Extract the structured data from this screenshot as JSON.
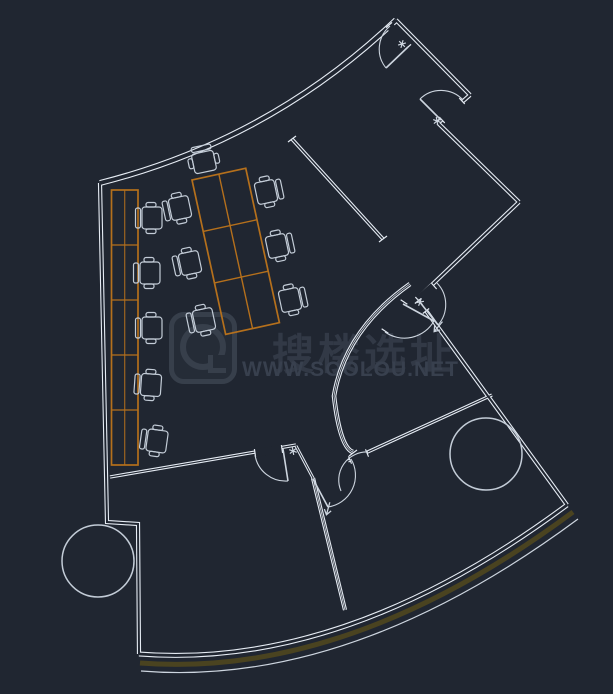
{
  "watermark": {
    "title": "搜楼选址",
    "url": "WWW.SOOLOU.NET",
    "logo_name": "soolou-logo"
  },
  "colors": {
    "background": "#202631",
    "wall": "#e6ecf4",
    "door": "#cdd5df",
    "desk": "#b5701c",
    "chair": "#c3ccd7",
    "olive": "#4a4320",
    "watermark_ink": "#333b48",
    "watermark_url": "#3a4250",
    "logo_line": "#39414d"
  },
  "floorplan": {
    "exterior_walls": [
      {
        "d": "M 100,183 Q 270,140 396,20",
        "w": 6
      },
      {
        "d": "M 396,20 L 470,95",
        "w": 4.2
      },
      {
        "d": "M 470,95 L 438,123",
        "w": 4.2
      },
      {
        "d": "M 438,123 L 519,202",
        "w": 4.2
      },
      {
        "d": "M 519,202 L 417,299",
        "w": 4.2
      },
      {
        "d": "M 419,301 L 567,505",
        "w": 4.2
      },
      {
        "d": "M 567,505 Q 345,670 139,654",
        "w": 5
      },
      {
        "d": "M 100,183 L 107,522 L 138,524 L 139,654",
        "w": 4.2
      }
    ],
    "interior_walls": [
      {
        "d": "M 292,139 L 383,239",
        "w": 3.6
      },
      {
        "d": "M 410,284 Q 345,330 334,396 Q 340,448 353,452",
        "w": 4.6,
        "hairline": true
      },
      {
        "d": "M 348,461 L 492,395",
        "w": 3.4
      },
      {
        "d": "M 110,477 L 296,445",
        "w": 3.4
      },
      {
        "d": "M 296,446 L 313,478",
        "w": 3
      },
      {
        "d": "M 313,478 L 345,610",
        "w": 4.2,
        "hairline": true
      }
    ],
    "facade_band": [
      {
        "d": "M 573,512 Q 348,679 140,663",
        "w": 5,
        "color": "olive"
      },
      {
        "d": "M 578,519 Q 350,688 141,671",
        "w": 1.2,
        "color": "door"
      }
    ],
    "openings": [
      [
        389,
        25,
        408,
        47
      ],
      [
        462,
        101,
        442,
        120
      ],
      [
        434,
        286,
        418,
        300
      ],
      [
        418,
        301,
        426,
        311
      ],
      [
        404,
        302,
        385,
        331
      ],
      [
        350,
        460,
        367,
        453
      ],
      [
        255,
        453,
        282,
        449
      ]
    ],
    "end_caps": [
      [
        288,
        142,
        296,
        136
      ],
      [
        379,
        242,
        387,
        236
      ],
      [
        349,
        456,
        357,
        450
      ]
    ],
    "doors": [
      {
        "leaf": "M 408,47 L 386,68",
        "arc": "M 386,68 A 30,30 0 0 1 390,26"
      },
      {
        "leaf": "M 441,120 L 420,99",
        "arc": "M 420,99 A 30,30 0 0 1 463,100"
      },
      {
        "leaf": "M 419,301 L 438,325",
        "arc": "M 437,283 A 31,31 0 0 1 438,325"
      },
      {
        "leaf": "M 403,304 L 434,321",
        "arc": "M 385,332 A 34,34 0 0 0 434,321"
      },
      {
        "arc": "M 368,452 A 28,28 0 0 0 341,491"
      },
      {
        "leaf": "M 313,479 L 328,507",
        "arc": "M 328,507 A 32,32 0 0 0 351,459"
      },
      {
        "leaf": "M 283,449 L 288,481",
        "arc": "M 255,455 A 31,31 0 0 0 288,481"
      }
    ],
    "markers": [
      {
        "x": 402,
        "y": 44,
        "rot": 45,
        "type": "stop"
      },
      {
        "x": 437,
        "y": 121,
        "rot": -40,
        "type": "stop"
      },
      {
        "x": 420,
        "y": 302,
        "rot": 50,
        "type": "stop"
      },
      {
        "x": 293,
        "y": 451,
        "rot": 80,
        "type": "stop"
      },
      {
        "x": 438,
        "y": 327,
        "rot": 40,
        "type": "arrow"
      },
      {
        "x": 328,
        "y": 509,
        "rot": 15,
        "type": "arrow"
      }
    ],
    "desk_bank_left": {
      "x": 111.5,
      "y": 190,
      "w": 26.5,
      "h": 275,
      "rows": 5
    },
    "desk_island": {
      "x": 192,
      "y": 180,
      "rot": -12.3,
      "w": 55,
      "h": 158,
      "cols": 2,
      "rows": 3
    },
    "chairs": [
      [
        152,
        218,
        0
      ],
      [
        150,
        273,
        0
      ],
      [
        152,
        328,
        0
      ],
      [
        151,
        385,
        4
      ],
      [
        157,
        441,
        8
      ],
      [
        180,
        208,
        -12
      ],
      [
        190,
        263,
        -12
      ],
      [
        204,
        320,
        -12
      ],
      [
        266,
        192,
        168
      ],
      [
        277,
        246,
        168
      ],
      [
        290,
        300,
        168
      ],
      [
        204,
        162,
        78
      ]
    ],
    "round_tables": [
      [
        98,
        561,
        36
      ],
      [
        486,
        454,
        36
      ]
    ]
  }
}
